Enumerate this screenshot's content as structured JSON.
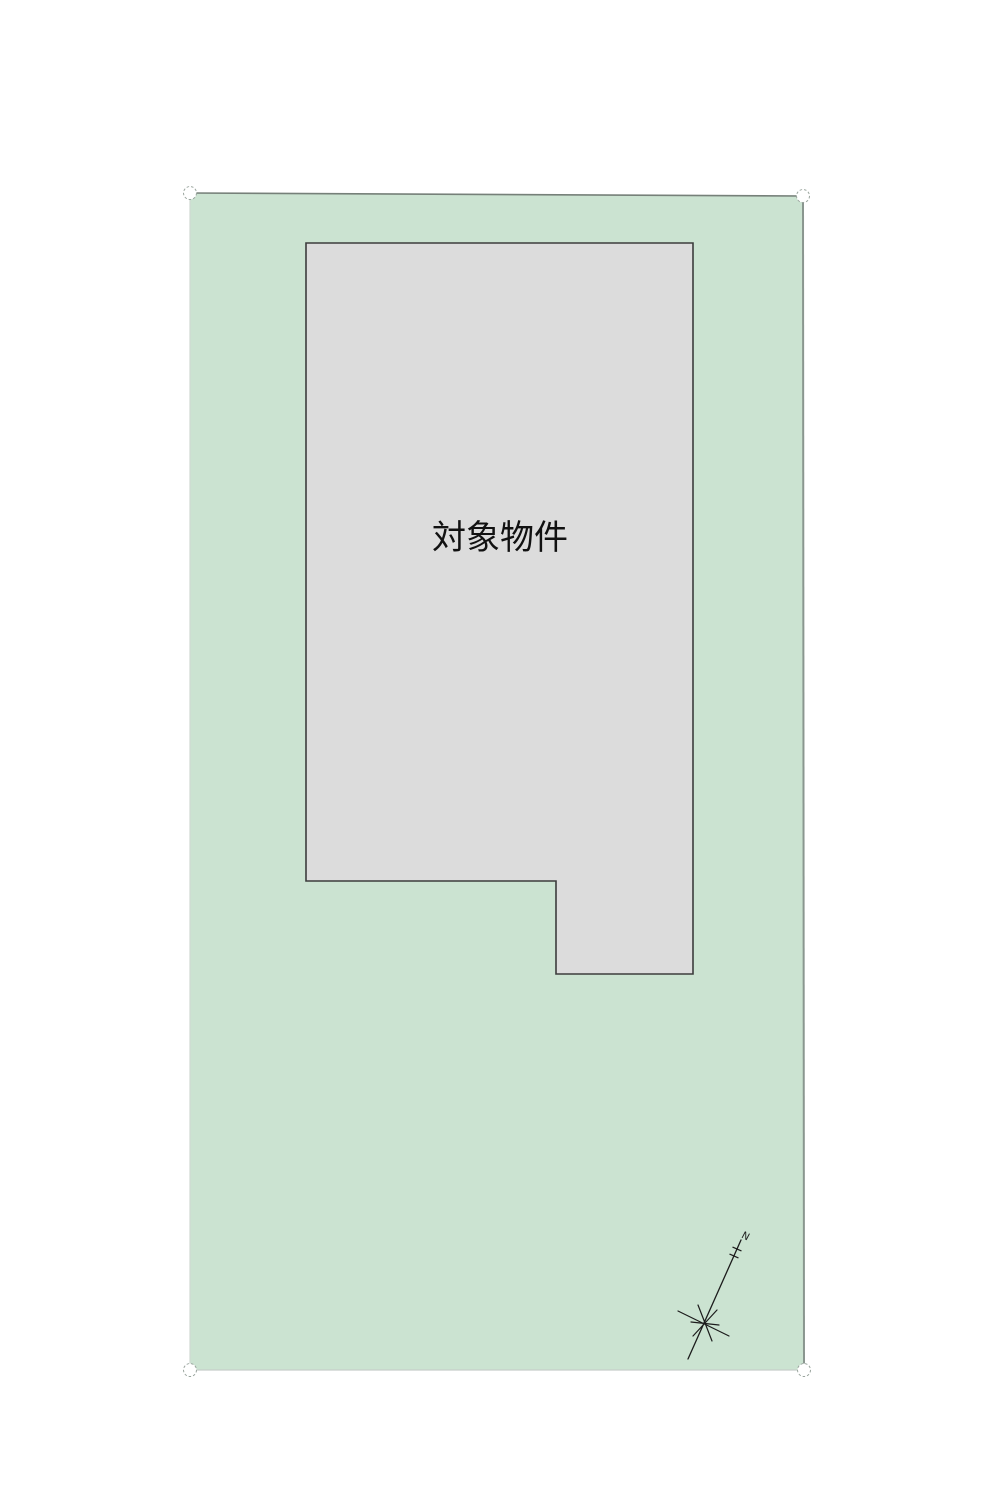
{
  "site_plan": {
    "building_label": "対象物件",
    "north_label": "N",
    "colors": {
      "background": "#ffffff",
      "parcel_fill": "#cbe3d1",
      "building_fill": "#dcdcdc",
      "building_border": "#3c3c3c",
      "parcel_border": "#8a968f",
      "corner_marker_stroke": "#9aa59e",
      "compass": "#1c1c1c",
      "label_text": "#111111"
    }
  }
}
